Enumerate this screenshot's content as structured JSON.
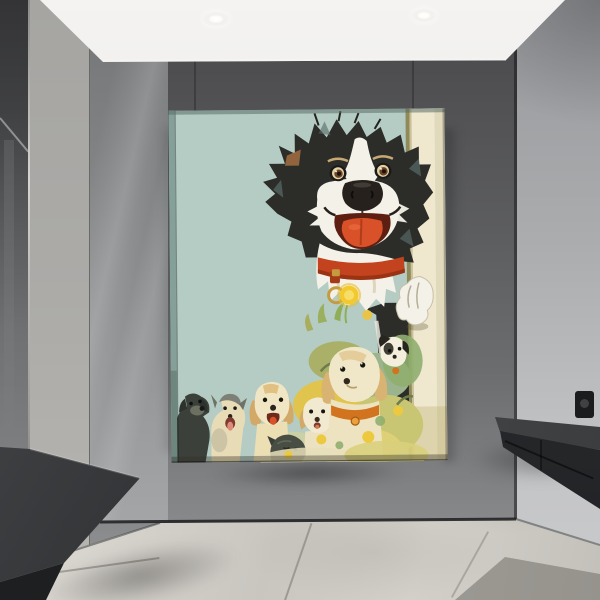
{
  "meta": {
    "image_type": "interior product photograph",
    "title": "portrait canvas wall art of cartoon dogs hanging in a modern gray hallway"
  },
  "scene": {
    "ceiling": {
      "lights_count": 2,
      "light_style": "recessed round downlights"
    },
    "left_side": [
      "dark wall mirror",
      "light gray column",
      "glossy gray wall panel",
      "floating dark bench"
    ],
    "right_side": [
      "gray wall panel",
      "black power socket",
      "floating black console shelf"
    ],
    "floor": "large light marble tiles with seams and one darker tile"
  },
  "artwork": {
    "type": "portrait canvas print",
    "subject": "cartoon border collie peeking around a door edge above seven puppies among yellow flowers",
    "main_dog": {
      "breed": "border collie",
      "colors": [
        "black",
        "white"
      ],
      "features": [
        "raised brows",
        "brown eyes",
        "big black nose",
        "open smiling mouth",
        "orange tongue",
        "red collar",
        "gold ring tag",
        "white paw gripping door edge",
        "tan ear patch"
      ]
    },
    "puppies": [
      {
        "position": 1,
        "look": "black puppy looking up"
      },
      {
        "position": 2,
        "look": "cream puppy with gray head patches and pink tongue"
      },
      {
        "position": 3,
        "look": "golden puppy with tan floppy ears, open mouth"
      },
      {
        "position": 4,
        "look": "charcoal gray puppy head"
      },
      {
        "position": 5,
        "look": "cream puppy with tan ears"
      },
      {
        "position": 6,
        "look": "large cream puppy with orange collar looking up"
      },
      {
        "position": 7,
        "look": "white puppy with black ear patches near the door"
      }
    ],
    "flora": "yellow dandelion blooms with sage, olive and straw foliage along the bottom"
  },
  "colors": {
    "ceiling-top": "#f4f3f1",
    "ceiling-bottom": "#cfcecc",
    "wall-top": "#47474a",
    "wall-bottom": "#97989a",
    "right-wall-top": "#97999c",
    "right-wall-bottom": "#cbccce",
    "glossy-top": "#737577",
    "glossy-bottom": "#a3a5a7",
    "column": "#acaba8",
    "mirror-dark": "#343436",
    "mirror-light": "#7c7e80",
    "floor-light": "#d8d5cf",
    "floor-dark": "#a5a29c",
    "bench": "#2c2e30",
    "console": "#27292b",
    "canvas-bg": "#b4ccc4",
    "canvas-side": "#84a099",
    "door-cream": "#efe8cf",
    "door-olive": "#8f8a58",
    "fur-black": "#2c2d29",
    "fur-white": "#f4f1e8",
    "fur-highlight": "#566866",
    "tongue": "#d85128",
    "mouth": "#5c1f12",
    "collar": "#c2431d",
    "gold": "#c49b3f",
    "pup-tan": "#d2a966",
    "pup-cream": "#efe6c6",
    "pup-gray": "#7d8076",
    "pup-black": "#3c403b",
    "pup-charcoal": "#494e44",
    "leaf-green": "#9cb48e",
    "leaf-olive": "#a9ad5e",
    "bloom-yellow": "#ecc93e",
    "pale-straw": "#e7dfba",
    "eye-brown": "#6f4423",
    "eye-cream": "#e2d2a8"
  }
}
